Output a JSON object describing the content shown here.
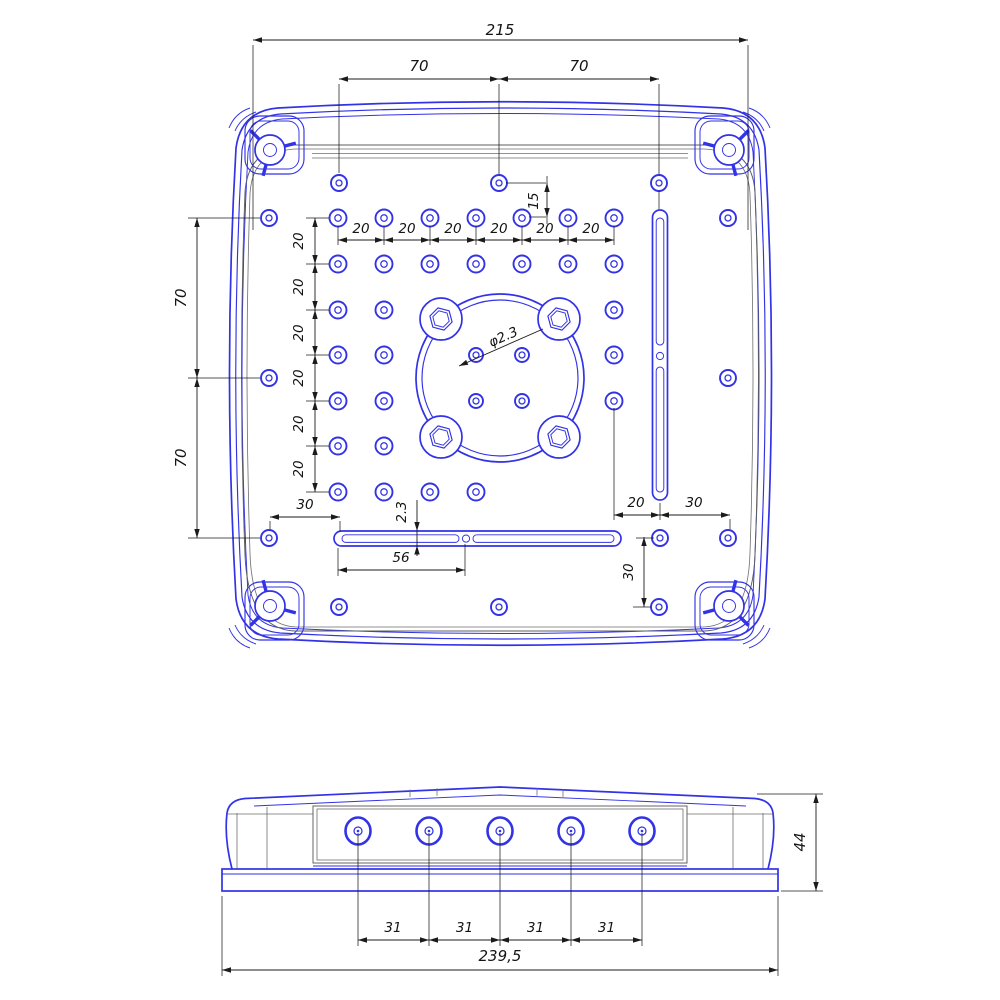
{
  "meta": {
    "background": "#ffffff",
    "part_line_color": "#3232e6",
    "detail_line_color": "#5e5e5e",
    "dimension_color": "#1b1b1b"
  },
  "top_view": {
    "dims": {
      "overall_width": "215",
      "top_hole_pitch": [
        "70",
        "70"
      ],
      "top_hole_offset": "15",
      "grid_col_pitch": [
        "20",
        "20",
        "20",
        "20",
        "20",
        "20"
      ],
      "grid_row_pitch": [
        "20",
        "20",
        "20",
        "20",
        "20",
        "20"
      ],
      "side_hole_pitch": [
        "70",
        "70"
      ],
      "corner_hole_offset": "30",
      "center_hole_dia": "φ2.3",
      "slot_width": "2.3",
      "slot_hole_offset": "56",
      "slot_to_grid": "20",
      "slot_to_side": "30",
      "bottom_hole_offset": "30"
    }
  },
  "side_view": {
    "dims": {
      "gland_pitch": [
        "31",
        "31",
        "31",
        "31"
      ],
      "overall_length": "239,5",
      "overall_height": "44"
    }
  }
}
